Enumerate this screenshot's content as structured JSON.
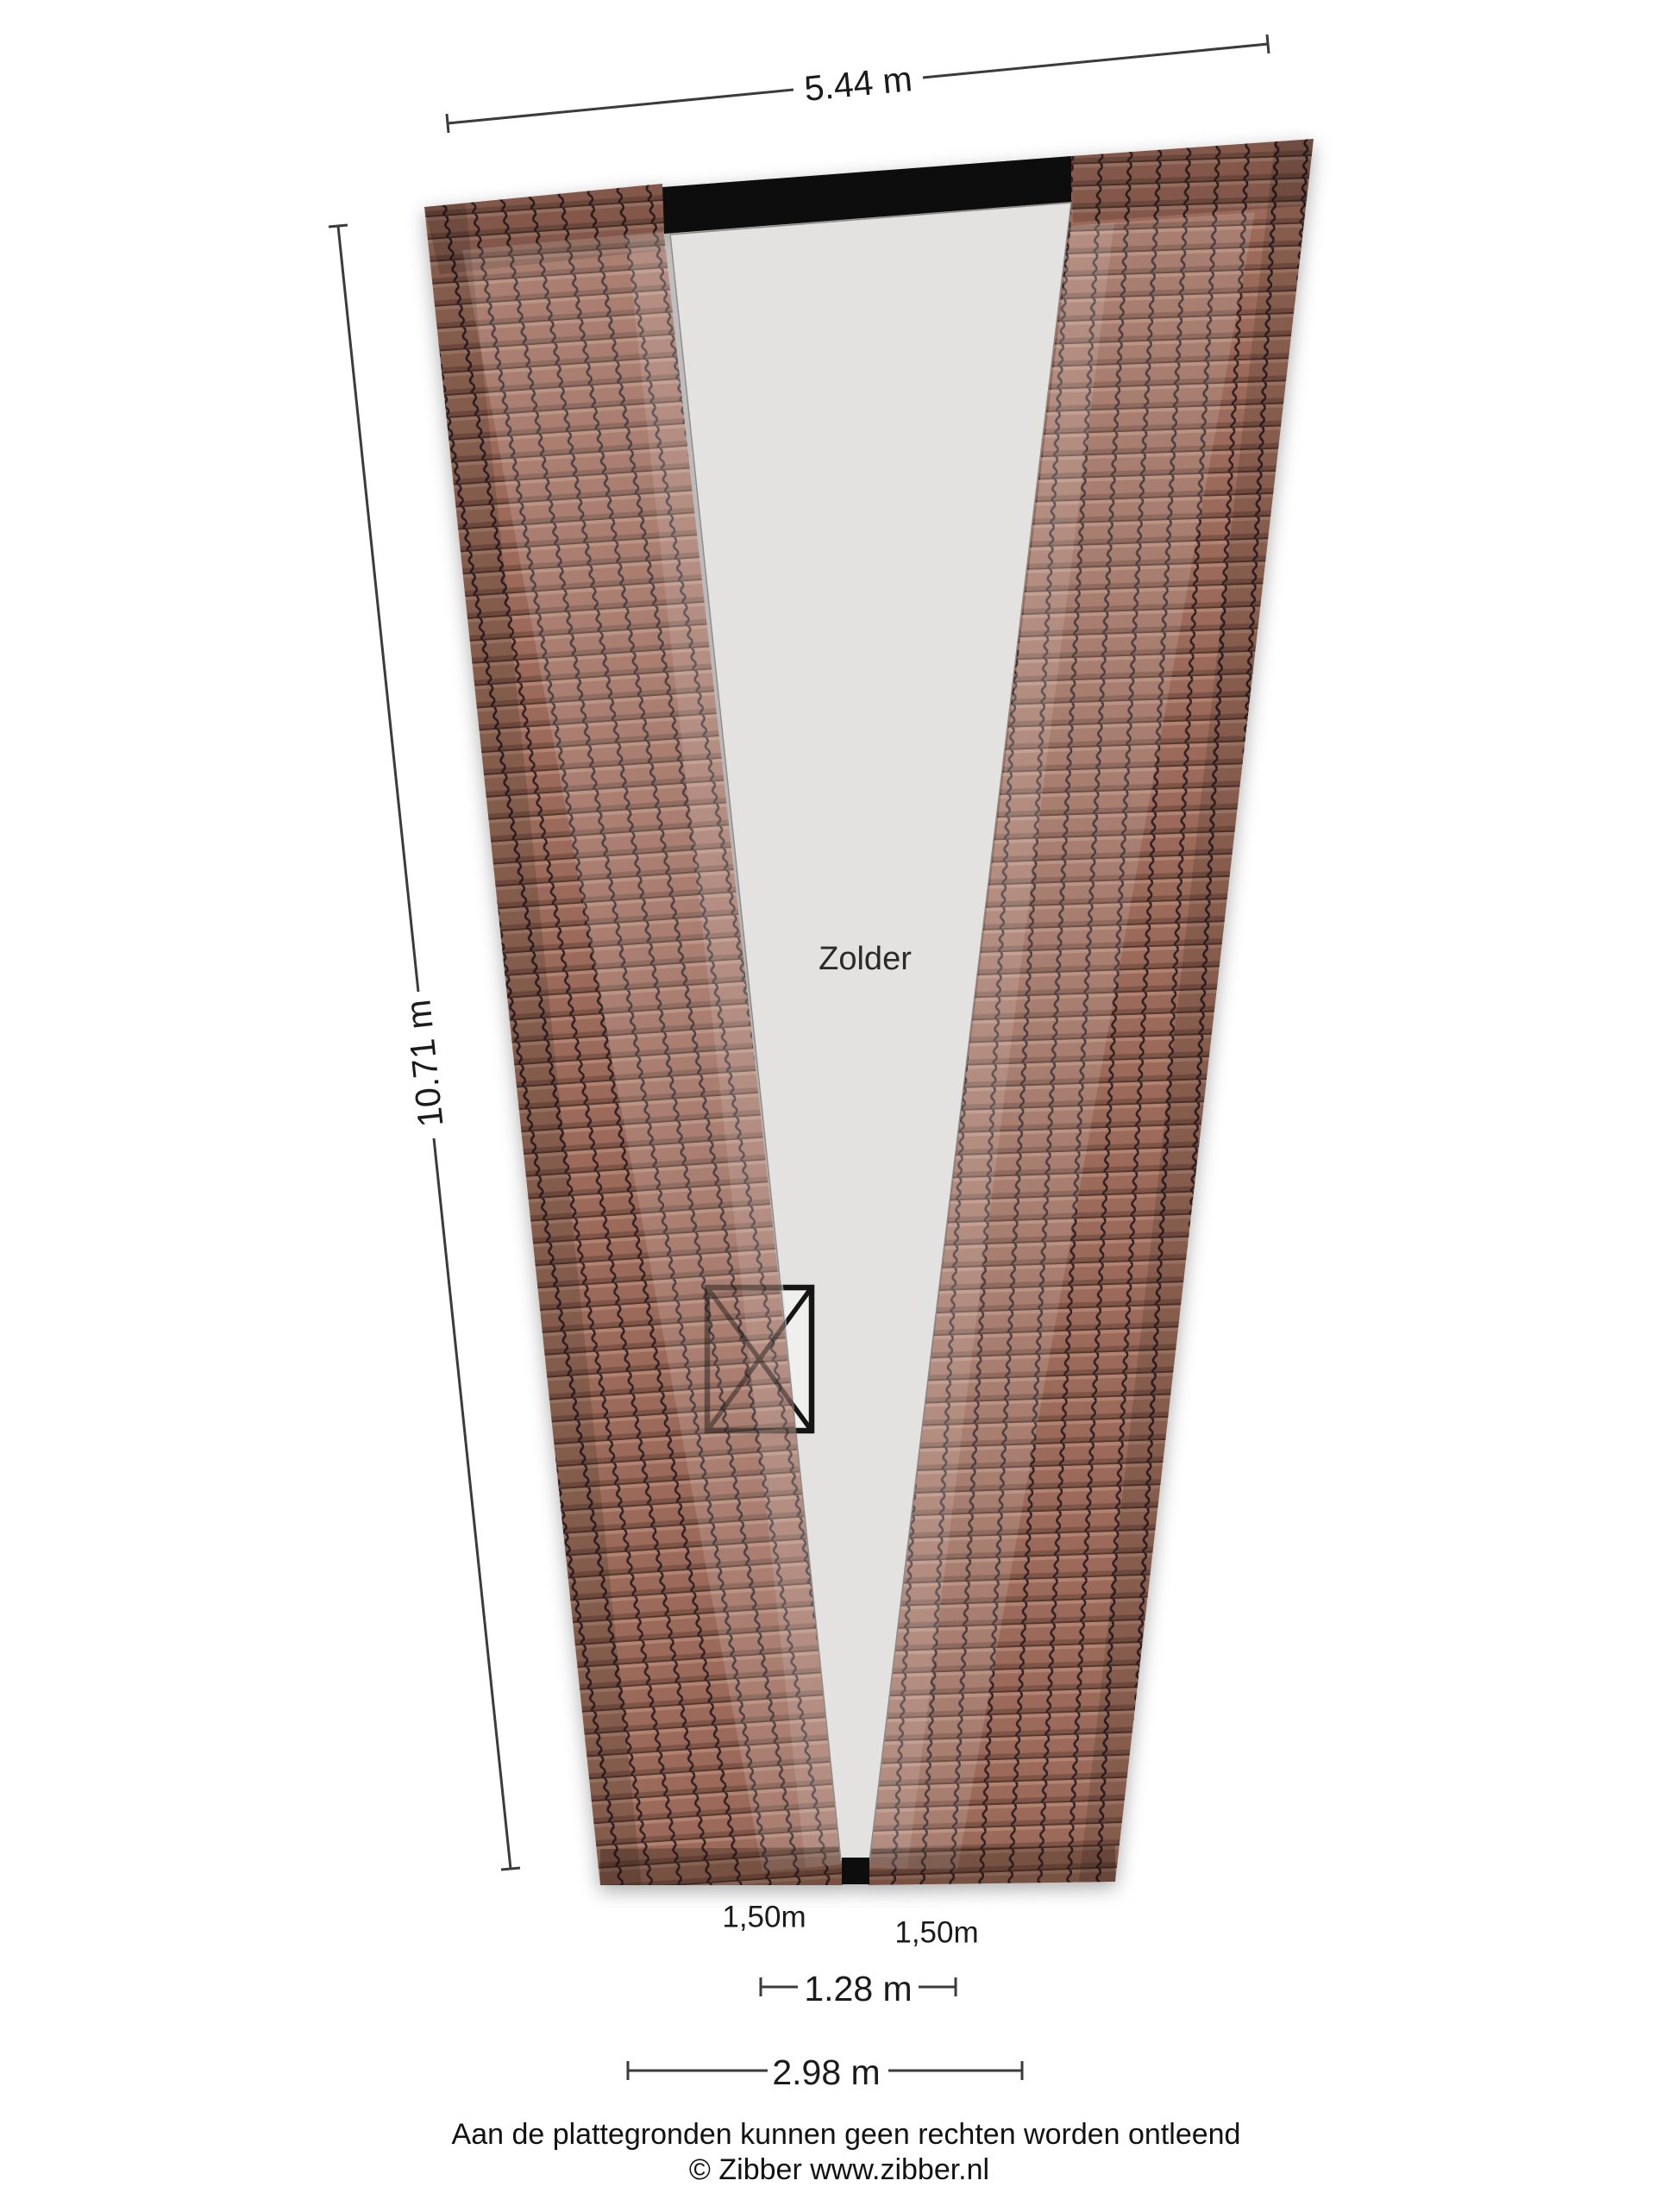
{
  "floorplan": {
    "room": {
      "label": "Zolder"
    },
    "dimensions": {
      "top_width": "5.44 m",
      "left_height": "10.71 m",
      "ceiling_height_left": "1,50m",
      "ceiling_height_right": "1,50m",
      "inner_width": "1.28 m",
      "bottom_width": "2.98 m"
    },
    "footer": {
      "disclaimer": "Aan de plattegronden kunnen geen rechten worden ontleend",
      "copyright": "© Zibber www.zibber.nl"
    },
    "colors": {
      "background": "#ffffff",
      "floor": "#e3e2e1",
      "roof_tile_base": "#9c6b5a",
      "roof_tile_line": "#332426",
      "top_bar": "#0c0c0c",
      "bottom_bar": "#0c0c0c",
      "dimension_lines": "#3b3b3b",
      "window_outline": "#151515"
    }
  }
}
